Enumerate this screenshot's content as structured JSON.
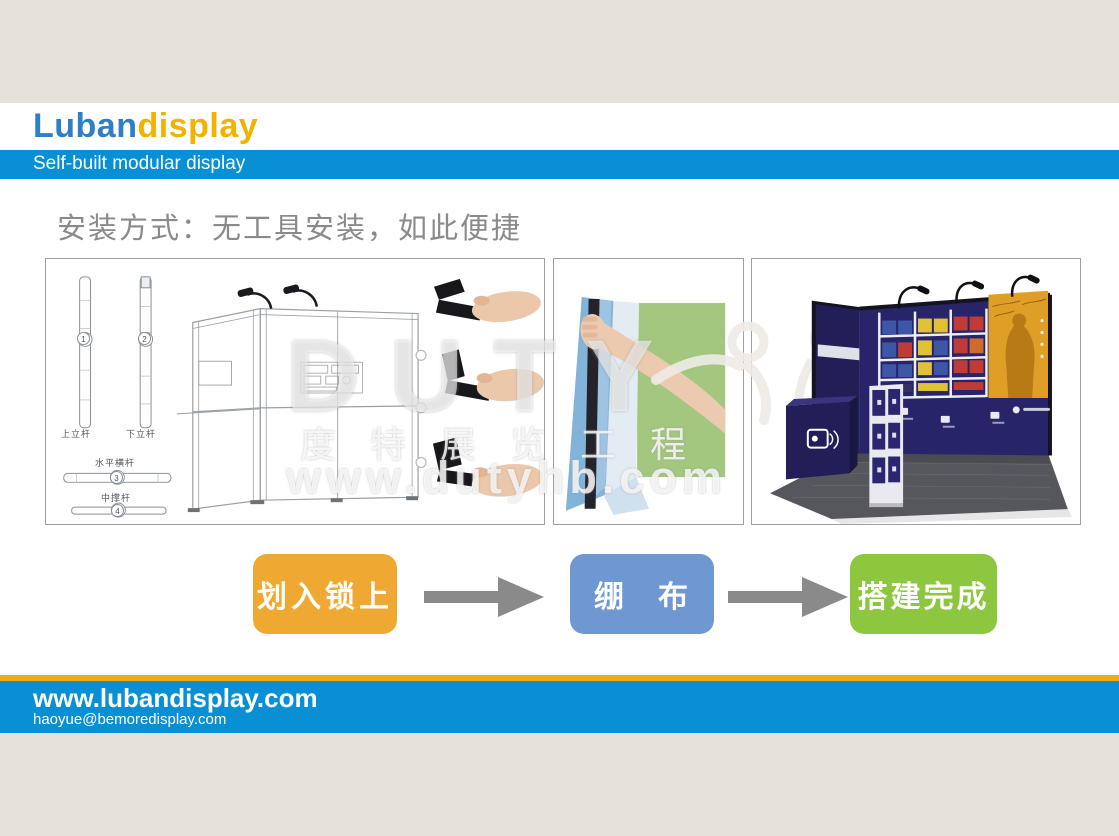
{
  "page": {
    "background": "#e7e1dc"
  },
  "header": {
    "logo_primary": "Luban",
    "logo_secondary": "display",
    "logo_primary_color": "#2e7fc4",
    "logo_secondary_color": "#f3b200",
    "tagline": "Self-built modular display",
    "bar_color": "#0990d4"
  },
  "main": {
    "title": "安装方式：无工具安装，如此便捷"
  },
  "diagram": {
    "pole_top_label": "上立杆",
    "pole_bottom_label": "下立杆",
    "horizontal_bar_label": "水平横杆",
    "middle_bar_label": "中撑杆",
    "num_1": "1",
    "num_2": "2",
    "num_3": "3",
    "num_4": "4"
  },
  "watermark": {
    "brand": "DUTY",
    "cn_text": "度特展览工程",
    "url": "www.dutyhb.com"
  },
  "steps": {
    "step1_label": "划入锁上",
    "step2_label": "绷　布",
    "step3_label": "搭建完成",
    "step1_color": "#efa932",
    "step2_color": "#6f97d2",
    "step3_color": "#8dc63f",
    "arrow_color": "#8a8a8a"
  },
  "footer": {
    "website": "www.lubandisplay.com",
    "email": "haoyue@bemoredisplay.com",
    "bar_color": "#0990d4",
    "accent_color": "#f0a81c"
  }
}
